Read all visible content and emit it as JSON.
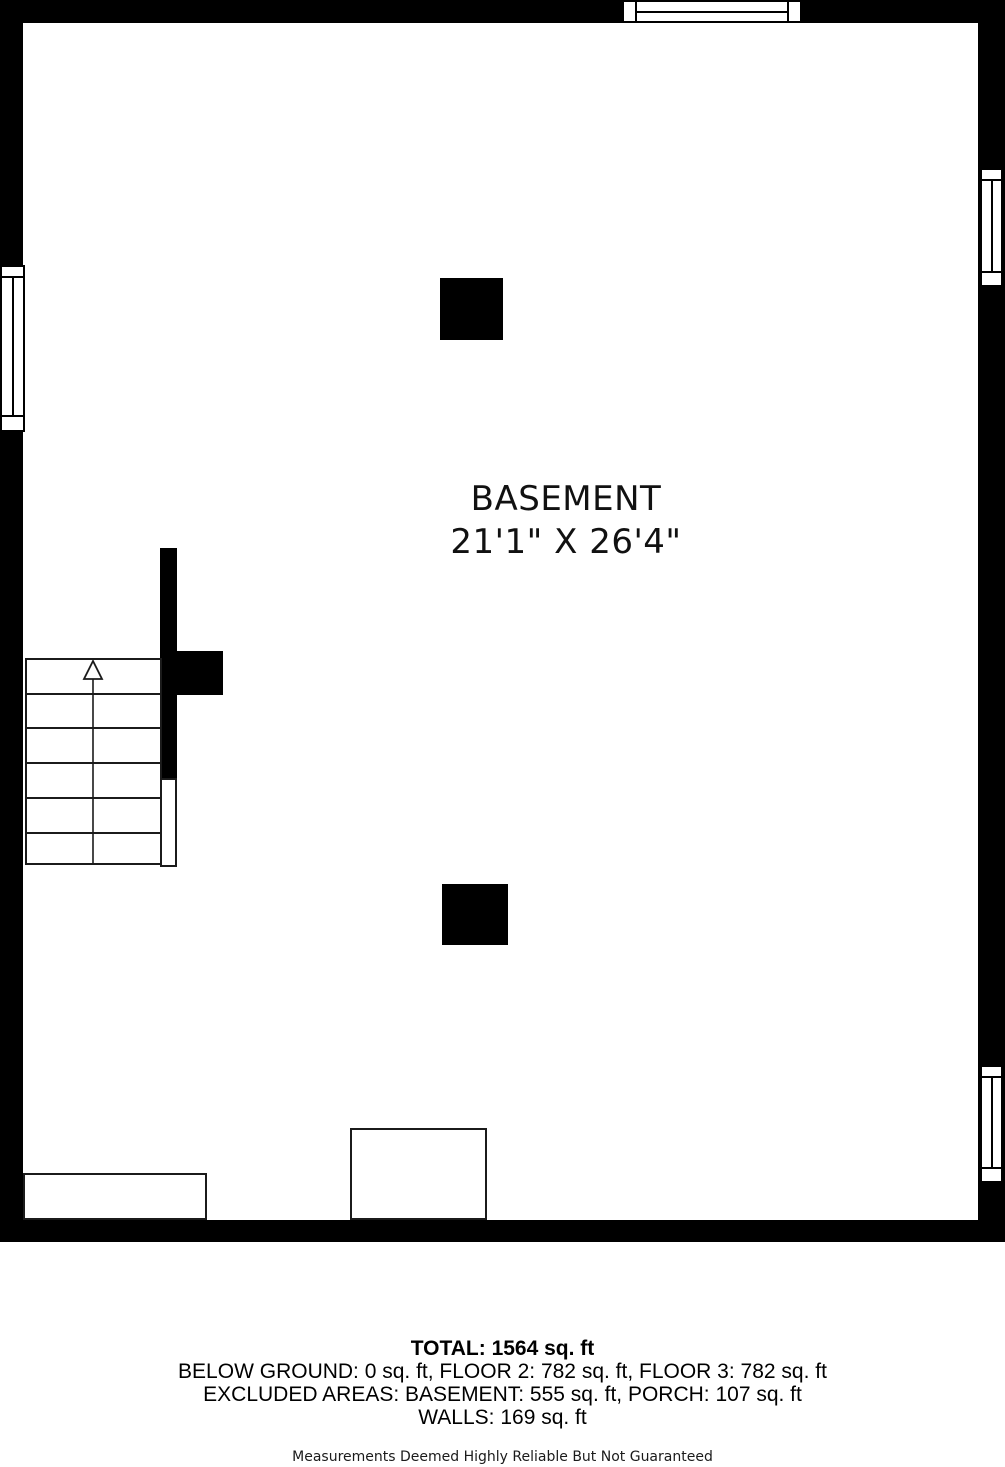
{
  "room": {
    "name": "BASEMENT",
    "dimensions": "21'1\" X 26'4\""
  },
  "summary": {
    "total": "TOTAL: 1564 sq. ft",
    "lines": [
      "BELOW GROUND: 0 sq. ft, FLOOR 2: 782 sq. ft, FLOOR 3: 782 sq. ft",
      "EXCLUDED AREAS: BASEMENT: 555 sq. ft, PORCH: 107 sq. ft",
      "WALLS: 169 sq. ft"
    ]
  },
  "disclaimer": "Measurements Deemed Highly Reliable But Not Guaranteed",
  "colors": {
    "wall": "#000000",
    "background": "#ffffff",
    "line": "#1b1b1b"
  }
}
